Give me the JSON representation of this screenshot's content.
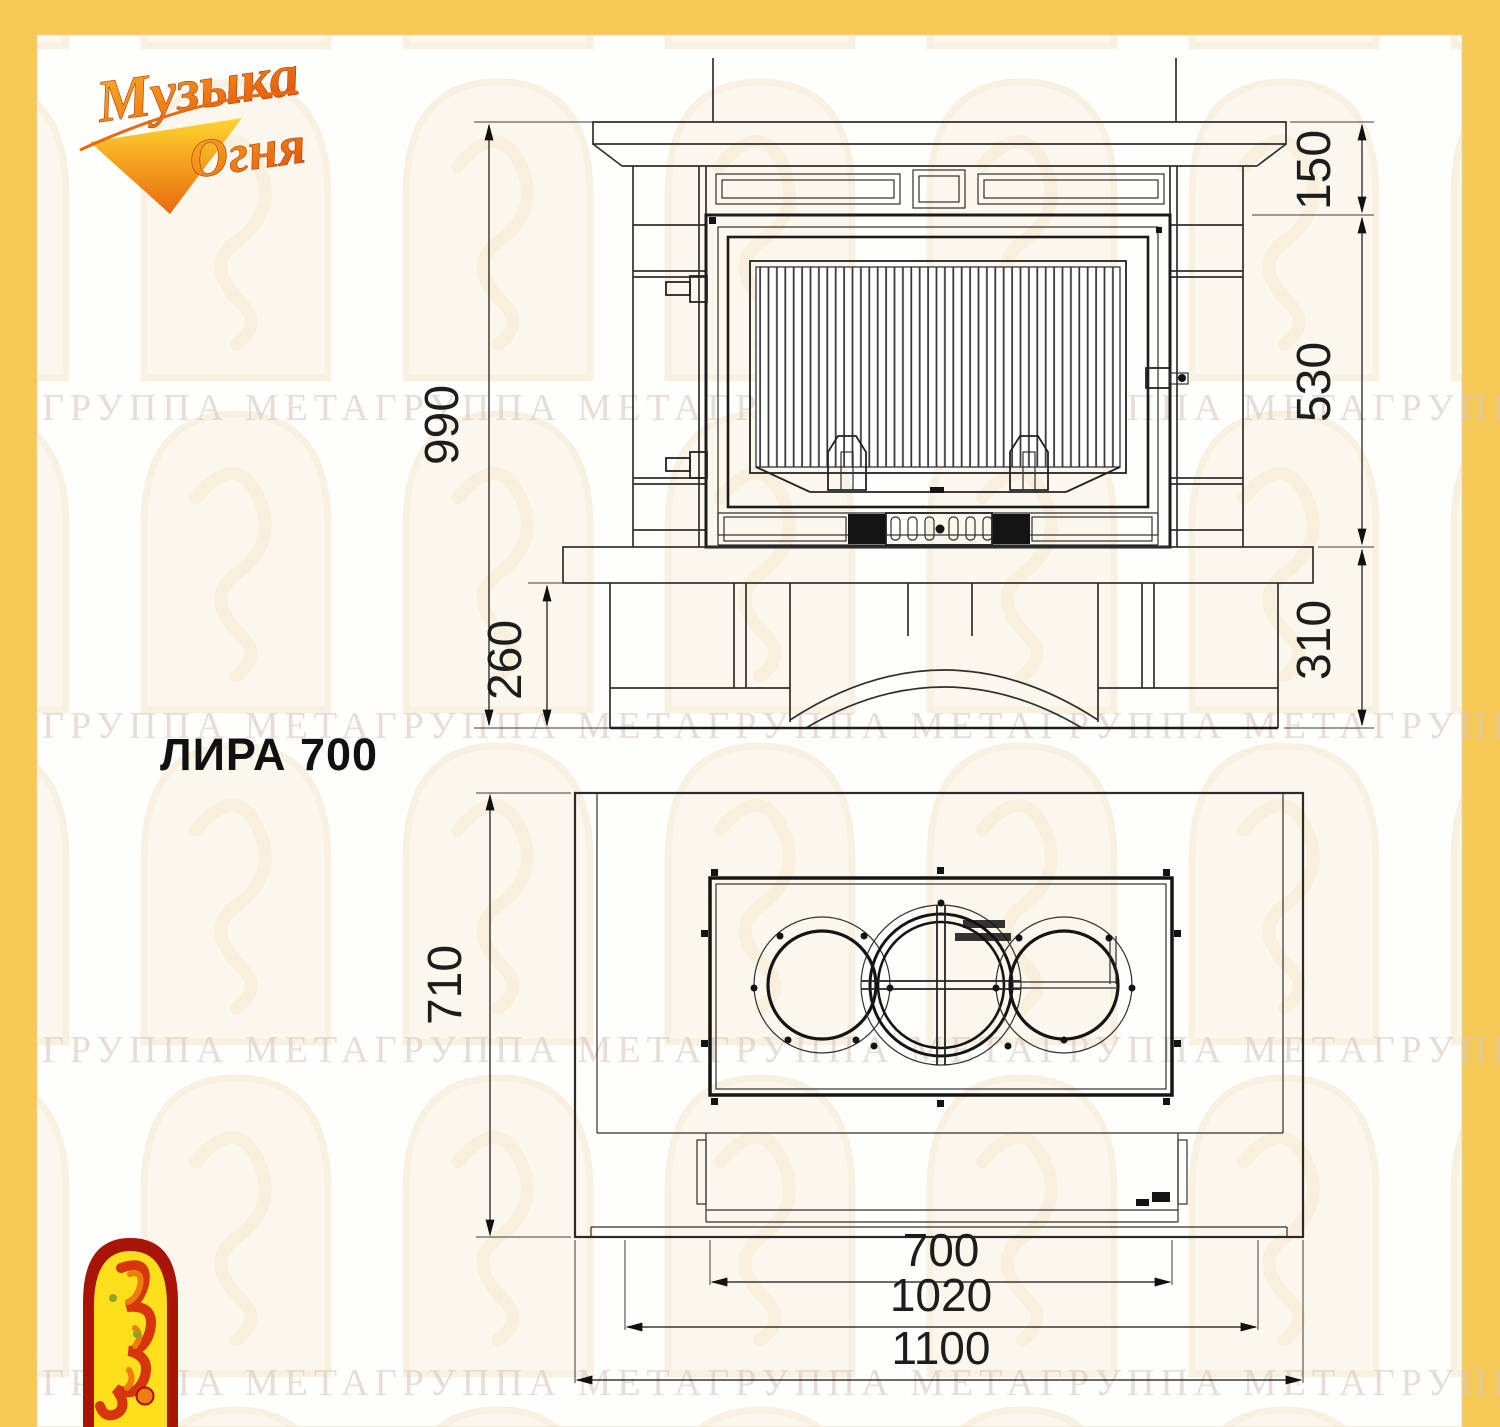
{
  "title": "ЛИРА 700",
  "brand": {
    "word1": "Музыка",
    "word2": "Огня"
  },
  "watermark": {
    "row_text": "ГРУППА МЕТАГРУППА МЕТАГРУППА МЕТАГРУППА МЕТАГРУППА МЕТА"
  },
  "front_view": {
    "view_name": "front-elevation",
    "total_height": "990",
    "plinth_height": "260",
    "mantel_height": "150",
    "firebox_height": "530",
    "base_height": "310"
  },
  "plan_view": {
    "view_name": "top-plan",
    "depth": "710",
    "firebox_width": "700",
    "portal_width": "1020",
    "total_width": "1100"
  },
  "colors": {
    "frame": "#F6C957",
    "line": "#2B2B2B",
    "watermark_text": "#D9C8C0",
    "logo_red": "#A81407",
    "logo_yellow": "#FFDE1C"
  }
}
